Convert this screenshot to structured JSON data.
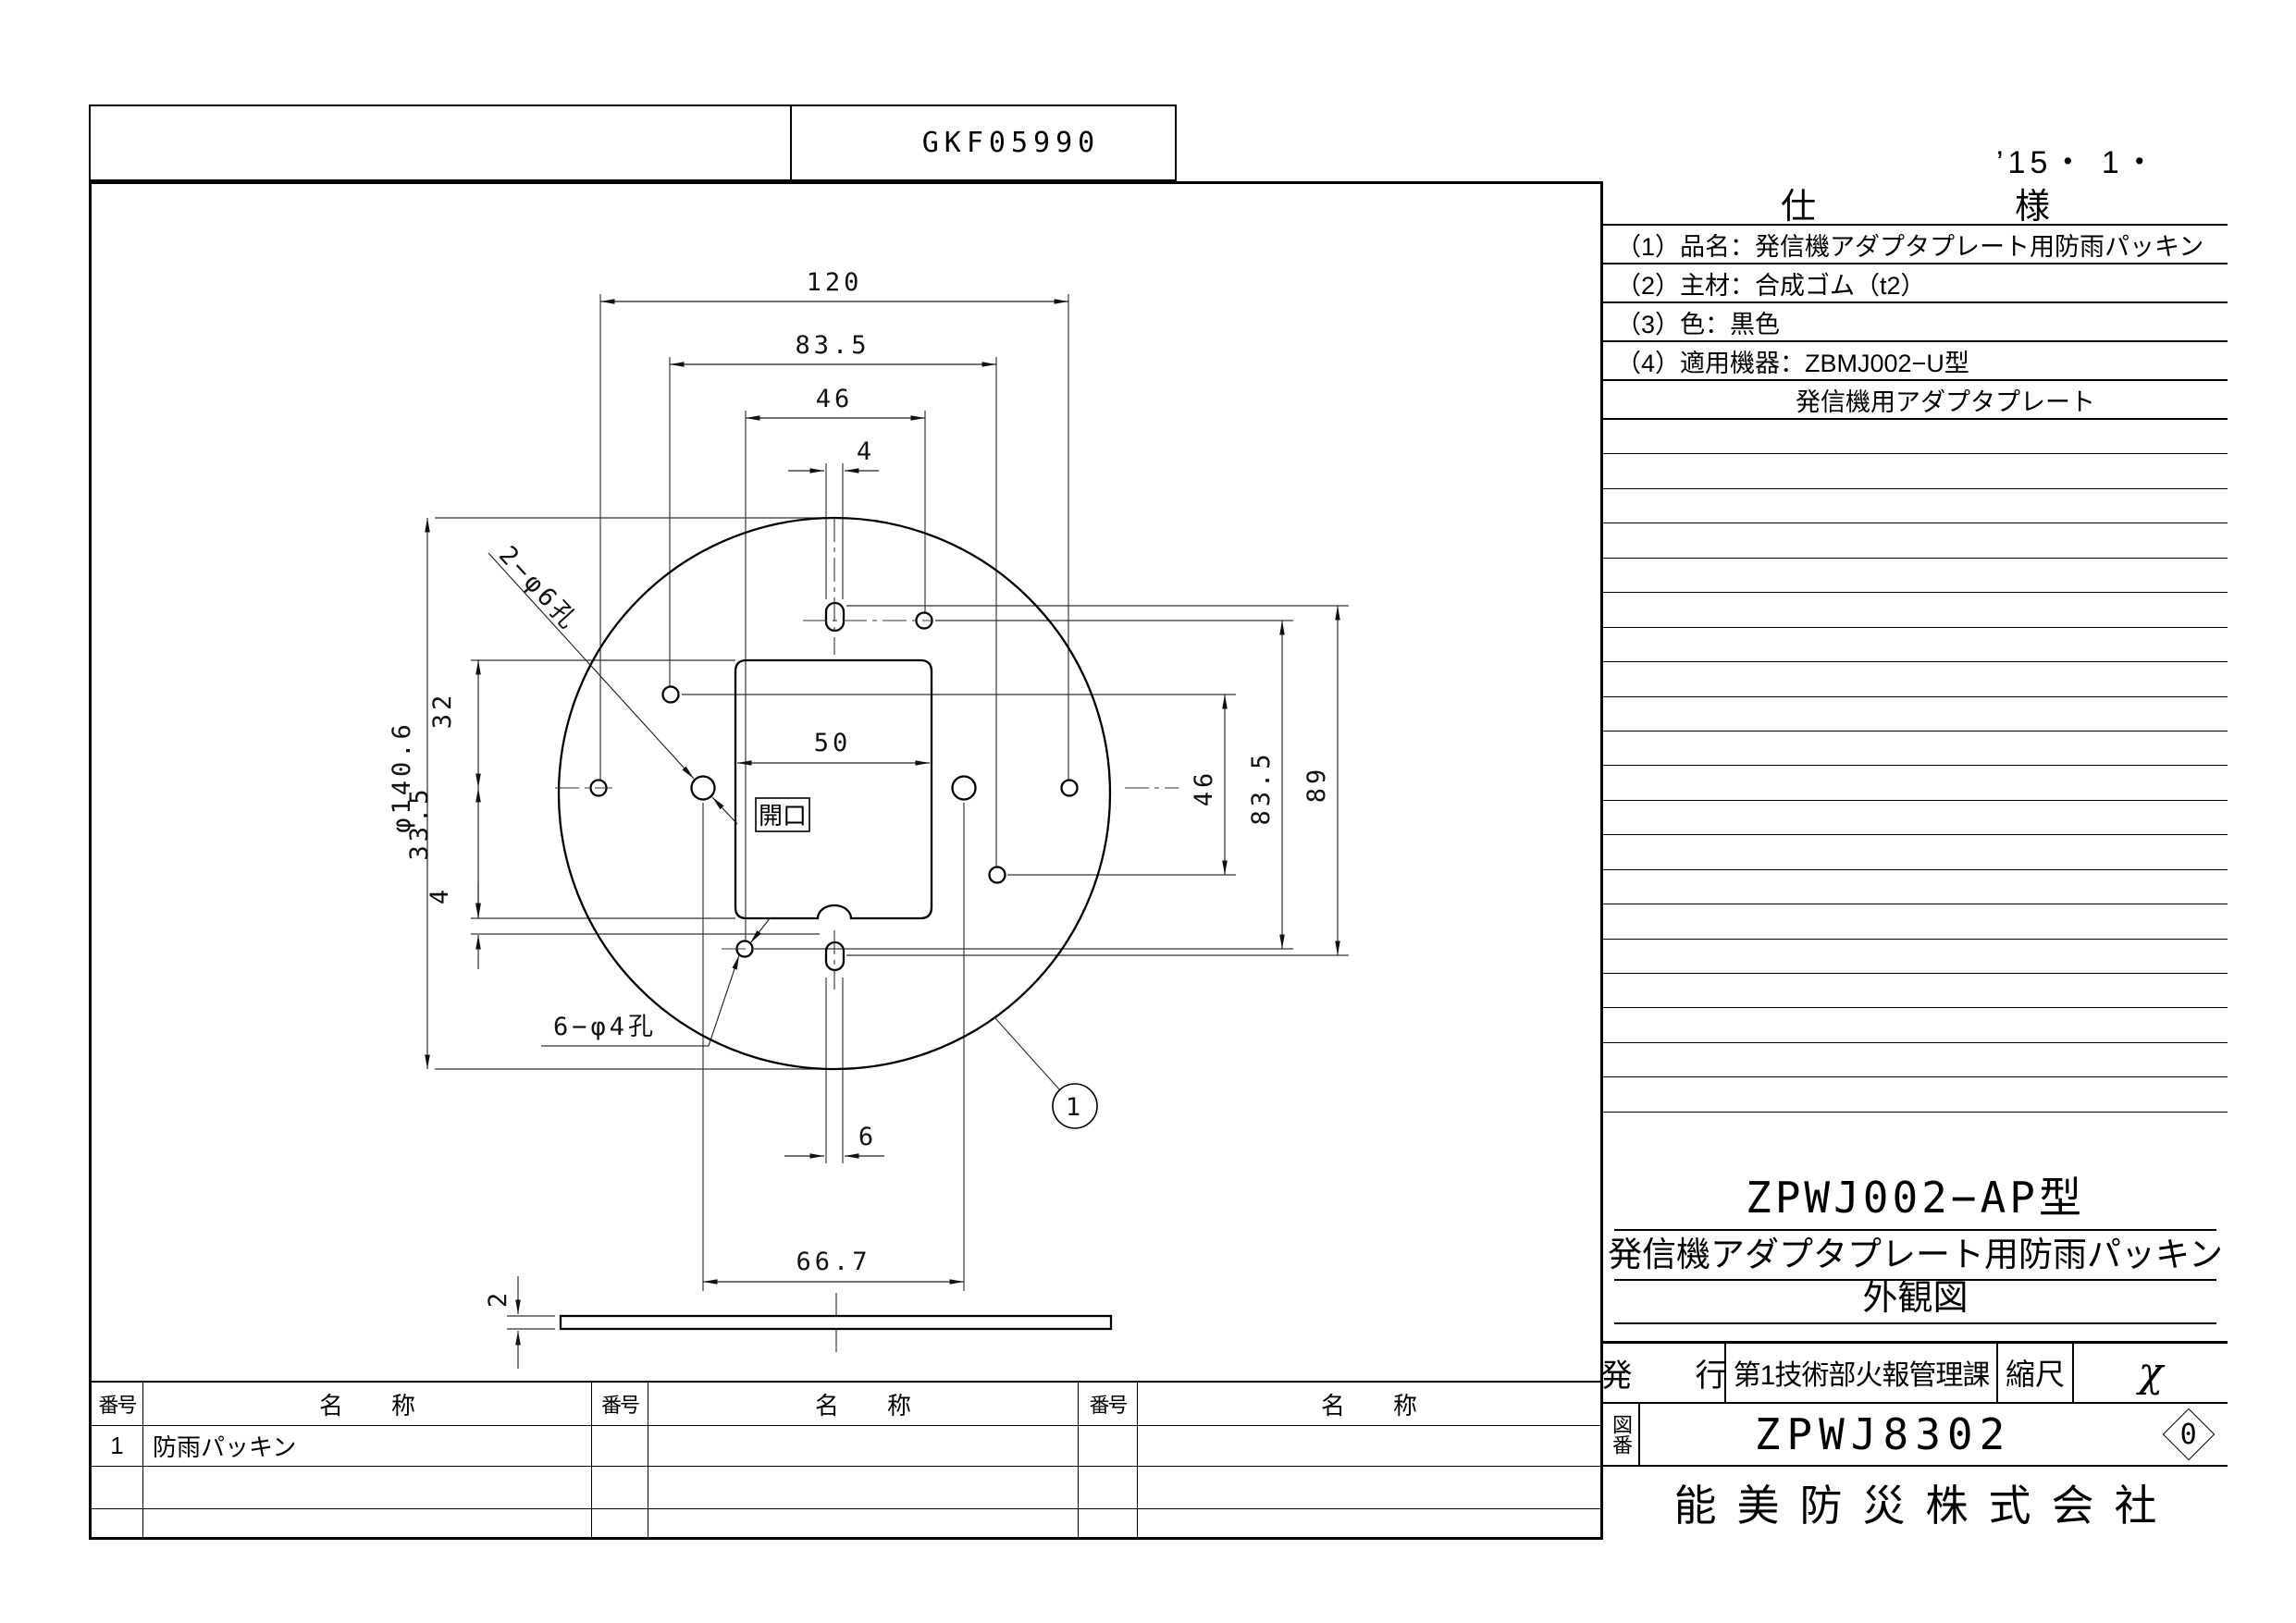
{
  "header": {
    "doc_code": "GKF05990",
    "date_note": "’15・ 1・"
  },
  "spec_panel": {
    "title_left": "仕",
    "title_right": "様",
    "rows": [
      "（1）品名：発信機アダプタプレート用防雨パッキン",
      "（2）主材：合成ゴム（t2）",
      "（3）色：黒色",
      "（4）適用機器：ZBMJ002−U型",
      "発信機用アダプタプレート"
    ]
  },
  "title_block": {
    "model": "ZPWJ002−AP型",
    "product_name": "発信機アダプタプレート用防雨パッキン",
    "drawing_type": "外観図",
    "issue_label": "発　　行",
    "department": "第1技術部火報管理課",
    "scale_label": "縮尺",
    "scale_value": "χ",
    "drawing_no_label": "図番",
    "drawing_no": "ZPWJ8302",
    "revision": "0",
    "company": "能美防災株式会社"
  },
  "parts_table": {
    "no_header": "番号",
    "name_header": "名　　称",
    "rows": [
      {
        "no": "1",
        "name": "防雨パッキン"
      }
    ]
  },
  "drawing": {
    "dims": {
      "top_width": "120",
      "mid_width": "83.5",
      "inner_width": "46",
      "slot_top_width": "4",
      "opening_width": "50",
      "diameter": "φ140.6",
      "upper_offset": "32",
      "lower_offset": "33.5",
      "notch_depth": "4",
      "right_inner": "46",
      "right_mid": "83.5",
      "right_overall": "89",
      "slot_bottom_width": "6",
      "hole_span": "66.7",
      "thickness": "2"
    },
    "labels": {
      "large_holes": "2−φ6孔",
      "small_holes": "6−φ4孔",
      "opening": "開口",
      "balloon_no": "1"
    }
  }
}
